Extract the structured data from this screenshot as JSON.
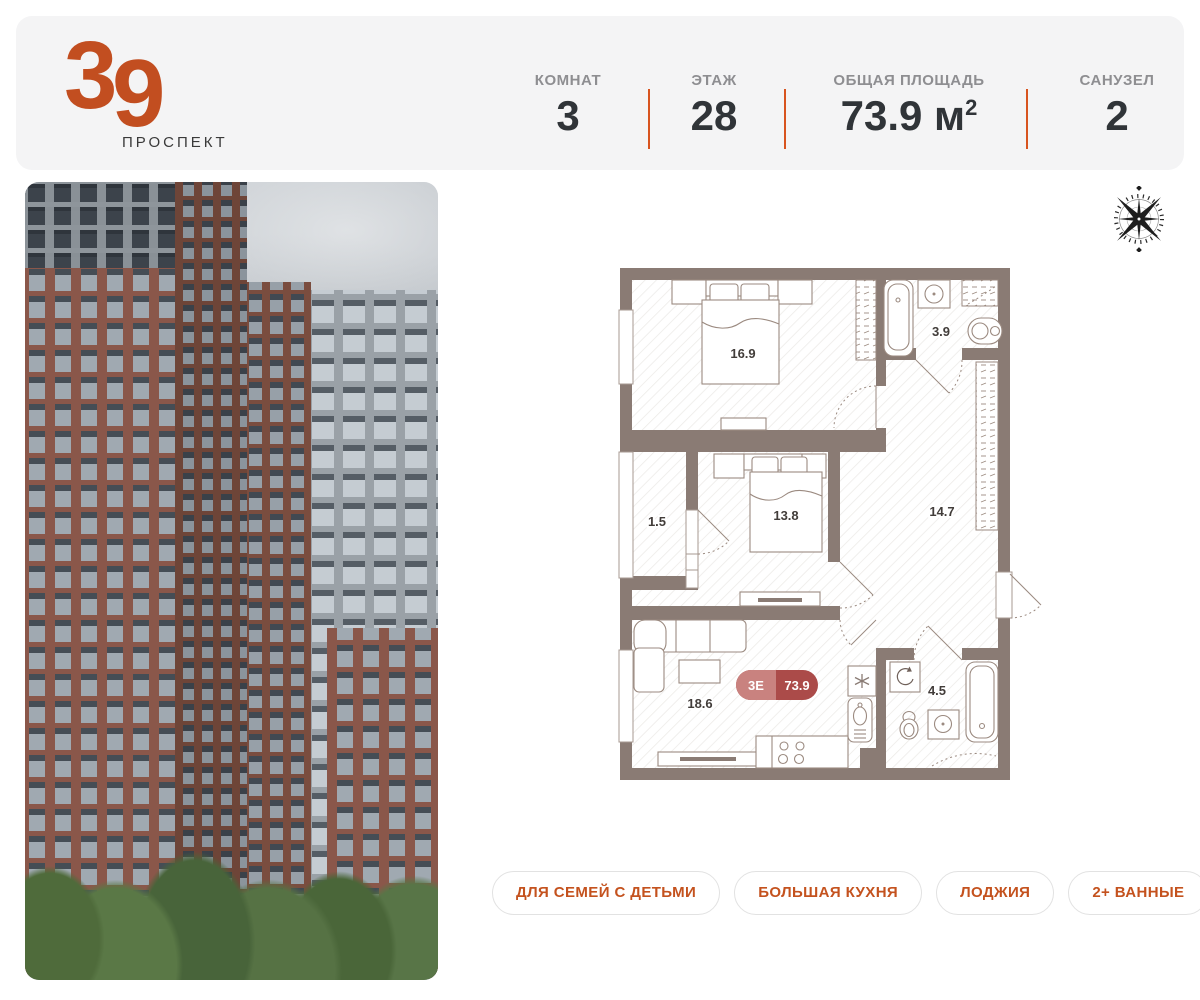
{
  "colors": {
    "accent_orange": "#c4521e",
    "logo_orange": "#c24e20",
    "divider_orange": "#d8541f",
    "header_bg": "#f4f4f5",
    "wall": "#8a7b74",
    "badge_left": "#c9827f",
    "badge_right": "#ab4b49",
    "label_gray": "#8e8e91",
    "value_dark": "#303438"
  },
  "header": {
    "logo_number": "39",
    "logo_subtitle": "ПРОСПЕКТ",
    "stats": [
      {
        "label": "КОМНАТ",
        "value": "3"
      },
      {
        "label": "ЭТАЖ",
        "value": "28"
      },
      {
        "label": "ОБЩАЯ ПЛОЩАДЬ",
        "value": "73.9 м",
        "sup": "2"
      },
      {
        "label": "САНУЗЕЛ",
        "value": "2"
      }
    ]
  },
  "plan": {
    "badge": {
      "layout": "3Е",
      "area": "73.9"
    },
    "rooms": {
      "bedroom1": "16.9",
      "bath_top": "3.9",
      "loggia": "1.5",
      "bedroom2": "13.8",
      "hall": "14.7",
      "kitchen": "18.6",
      "bath_bottom": "4.5"
    }
  },
  "tags": [
    {
      "label": "ДЛЯ СЕМЕЙ С ДЕТЬМИ"
    },
    {
      "label": "БОЛЬШАЯ КУХНЯ"
    },
    {
      "label": "ЛОДЖИЯ"
    },
    {
      "label": "2+ ВАННЫЕ"
    }
  ]
}
